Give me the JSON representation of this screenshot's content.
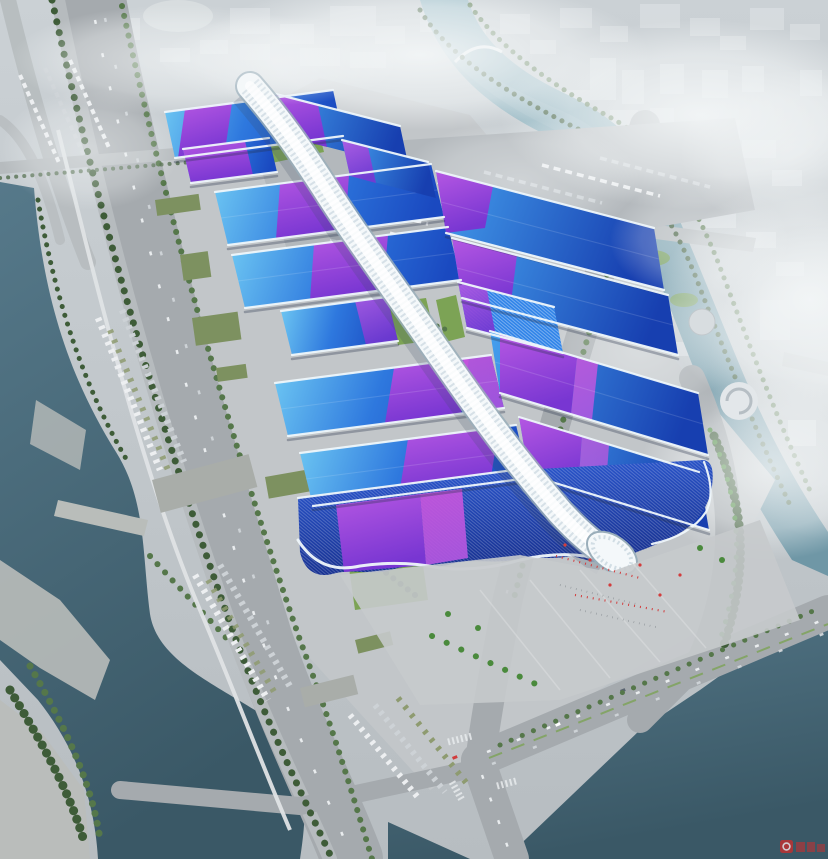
{
  "meta": {
    "alt": "Aerial architectural rendering of a huge exhibition and convention center: two rows of wave-shaped exhibition halls with blue metallic roofs crossed by purple ribbon bands, joined by a white sinuous central concourse tube ending at a grand entrance hall and plaza with red flags; the site is ringed by tree-lined boulevards, bus and truck parking lots, canals and rivers, with a hazy white city skyline beyond",
    "type": "architectural-aerial-rendering"
  },
  "palette": {
    "bg-top": "#cbd1d5",
    "bg-bottom": "#b7bdc1",
    "site": "#c2c6c9",
    "plaza": "#c7cacc",
    "road": "#a5aaae",
    "road-light": "#b6bbbe",
    "lane": "#e9ecee",
    "canal-light": "#a3c2cc",
    "canal-deep": "#6f97a6",
    "river-light": "#56798a",
    "river-deep": "#3a5866",
    "terrace": "#b9bdba",
    "bank": "#8fa08b",
    "tree-dark": "#3e5c38",
    "tree-mid": "#55774a",
    "palm": "#4a8a3c",
    "lawn": "#7ca355",
    "hall-edge": "#6fc9f3",
    "hall-mid": "#2e78de",
    "hall-deep": "#1a49c0",
    "hallr-edge": "#45a0ee",
    "hallr-deep": "#173fb0",
    "ribbon-light": "#b557e2",
    "ribbon-deep": "#7836d2",
    "magenta": "#cc55dc",
    "spine-white": "#f4f8fa",
    "spine-shade": "#c2d1da",
    "spine-outline": "#9aaeba",
    "spine-shadow": "#3a4a66",
    "entr-mid": "#2c5bd6",
    "entr-deep": "#162f8e",
    "rim": "#eff7fb",
    "hall-shadow": "#26314a",
    "city": "#dadfe2",
    "fog": "#f3f6f7",
    "vehicle": "#edeff1",
    "bus-olive": "#8e9b70",
    "flag-red": "#d23c3c",
    "people": "#6a7076",
    "wm": "#c62f2f",
    "green-roof": "#7d9160",
    "warehouse": "#a9ada9"
  },
  "scene": {
    "complex": {
      "name": "exhibition-center-complex",
      "halls_left_count": 7,
      "halls_right_count": 7,
      "features": [
        "central-spine-concourse",
        "entrance-hall",
        "entrance-plaza",
        "roof-ribbon-bands",
        "green-roof-warehouses"
      ]
    },
    "environment": [
      "west-river",
      "east-canal",
      "south-water",
      "tree-lined-boulevard",
      "truck-parking",
      "bus-parking",
      "hazy-city-skyline",
      "fog"
    ],
    "watermark": {
      "color": "#c62f2f"
    }
  }
}
